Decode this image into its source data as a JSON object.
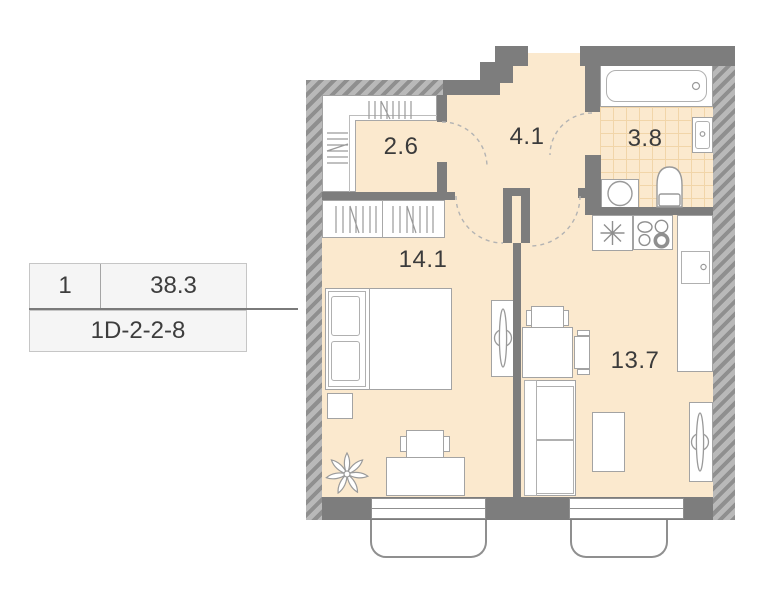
{
  "unit_card": {
    "number": "1",
    "area_total": "38.3",
    "unit_code": "1D-2-2-8"
  },
  "rooms": {
    "closet": {
      "label": "2.6"
    },
    "hallway": {
      "label": "4.1"
    },
    "bathroom": {
      "label": "3.8"
    },
    "bedroom": {
      "label": "14.1"
    },
    "living": {
      "label": "13.7"
    }
  },
  "colors": {
    "floor": "#fbe9ce",
    "tile_line": "#f1d5a9",
    "wall_solid": "#7d7d7d",
    "wall_hatch_dark": "#8f8f8f",
    "wall_hatch_light": "#b9b9b9",
    "furniture_stroke": "#a3a3a3",
    "text": "#3b3b3b",
    "card_background": "#f5f5f5"
  }
}
